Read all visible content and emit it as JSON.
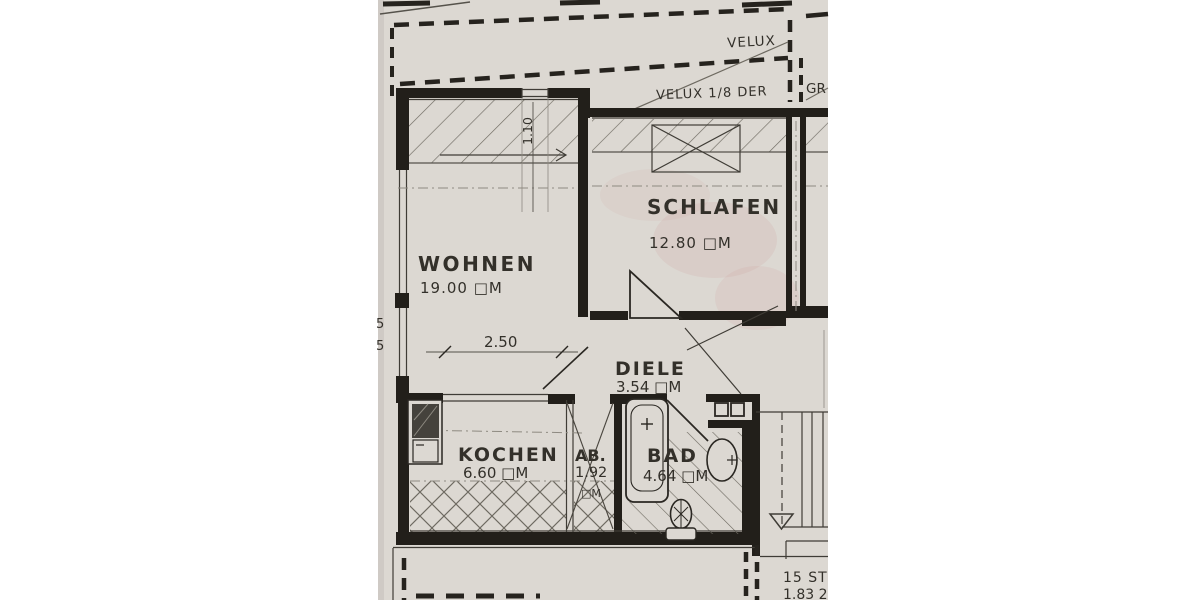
{
  "colors": {
    "background": "#ffffff",
    "paper": "#dcd8d2",
    "paper_edge": "#c9c5bf",
    "ink_wall": "#221f1a",
    "ink_heavy_dash": "#26231e",
    "line_thin": "#3f3c36",
    "line_mid": "#55524b",
    "line_faint": "#8e8a81",
    "hatch": "#6e6a61",
    "unit_dark": "#45423c",
    "smudge_pink": "#cc9898"
  },
  "rooms": [
    {
      "name": "WOHNEN",
      "area": "19.00 □M"
    },
    {
      "name": "SCHLAFEN",
      "area": "12.80 □M"
    },
    {
      "name": "DIELE",
      "area": "3.54 □M"
    },
    {
      "name": "KOCHEN",
      "area": "6.60 □M"
    },
    {
      "name": "AB.",
      "area": "1.92",
      "area_unit": "□M"
    },
    {
      "name": "BAD",
      "area": "4.64 □M"
    }
  ],
  "roof_labels": {
    "velux": "VELUX",
    "velux_fraction": "VELUX 1/8 DER",
    "adjacent_partial": "GR"
  },
  "dimensions": {
    "wohnen_width": "2.50",
    "skylight_height": "1.10",
    "left_upper": "5",
    "left_lower": "5",
    "stairs_count": "15 ST",
    "stairs_partial": "1.83 2"
  }
}
